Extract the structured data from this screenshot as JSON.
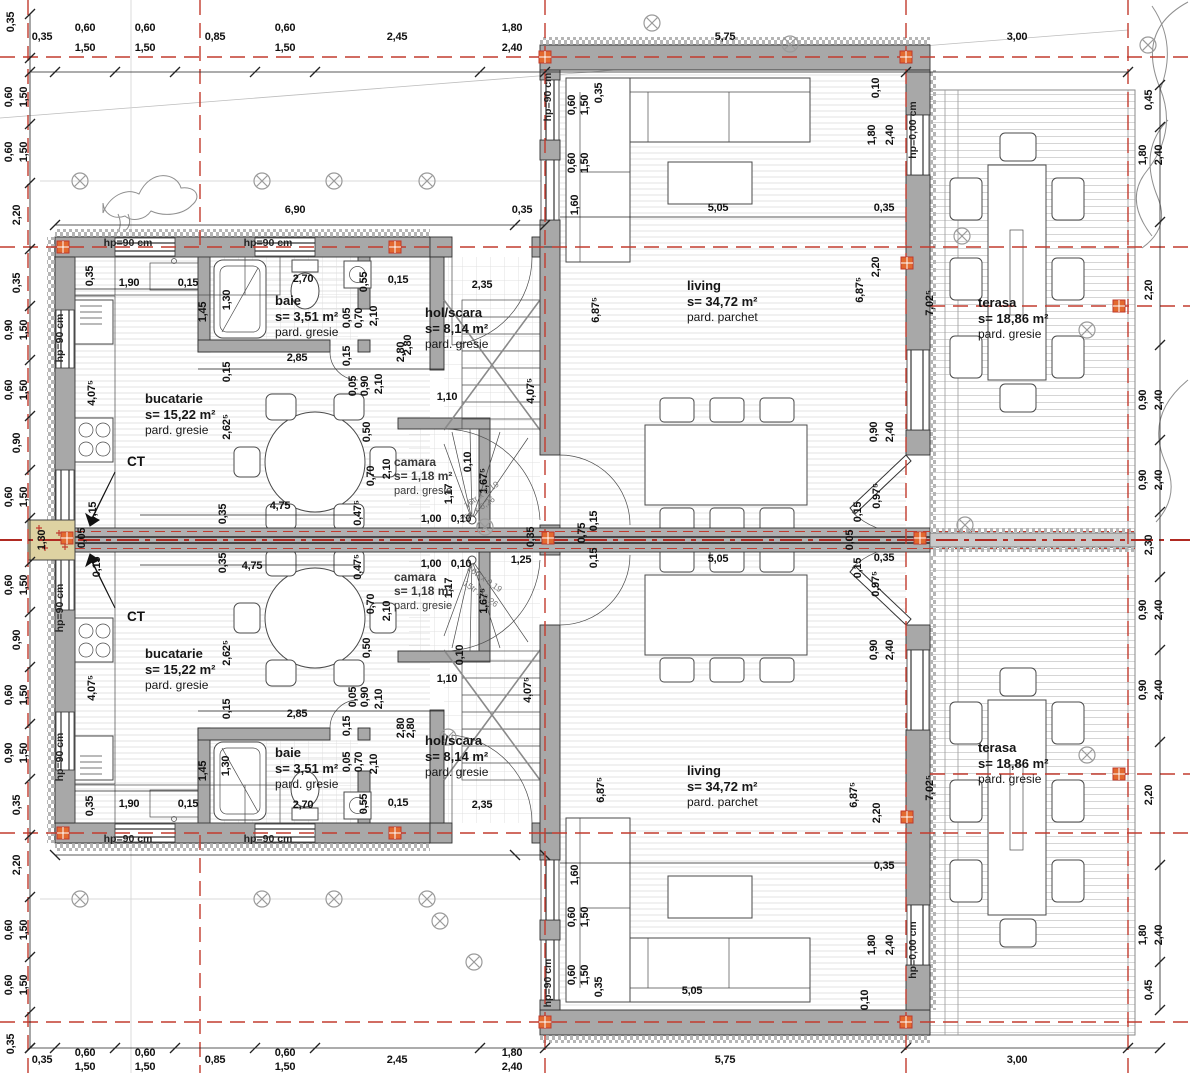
{
  "rooms": {
    "bucatarie": {
      "name": "bucatarie",
      "area": "s= 15,22 m²",
      "floor": "pard. gresie"
    },
    "baie": {
      "name": "baie",
      "area": "s= 3,51 m²",
      "floor": "pard. gresie"
    },
    "hol": {
      "name": "hol/scara",
      "area": "s= 8,14 m²",
      "floor": "pard. gresie"
    },
    "camara": {
      "name": "camara",
      "area": "s= 1,18 m²",
      "floor": "pard. gresie"
    },
    "living": {
      "name": "living",
      "area": "s= 34,72 m²",
      "floor": "pard. parchet"
    },
    "terasa": {
      "name": "terasa",
      "area": "s= 18,86 m²",
      "floor": "pard. gresie"
    }
  },
  "annotations": {
    "ct": "CT",
    "hp90": "hp=90 cm",
    "hp0": "hp=0,00 cm",
    "stair_note_a": "16tr x 0,19",
    "stair_note_b": "15tr x 0,26"
  },
  "dims": {
    "values": {
      "d005": "0,05",
      "d010": "0,10",
      "d015": "0,15",
      "d035": "0,35",
      "d045": "0,45",
      "d0475": "0,47⁵",
      "d050": "0,50",
      "d055": "0,55",
      "d060": "0,60",
      "d070": "0,70",
      "d075": "0,75",
      "d085": "0,85",
      "d090": "0,90",
      "d0975": "0,97⁵",
      "d100": "1,00",
      "d110": "1,10",
      "d117": "1,17",
      "d125": "1,25",
      "d130": "1,30",
      "d145": "1,45",
      "d150": "1,50",
      "d160": "1,60",
      "d1675": "1,67⁵",
      "d180": "1,80",
      "d190": "1,90",
      "d210": "2,10",
      "d220": "2,20",
      "d230": "2,30",
      "d235": "2,35",
      "d240": "2,40",
      "d245": "2,45",
      "d2625": "2,62⁵",
      "d270": "2,70",
      "d280": "2,80",
      "d285": "2,85",
      "d300": "3,00",
      "d4075": "4,07⁵",
      "d475": "4,75",
      "d505": "5,05",
      "d575": "5,75",
      "d6875": "6,87⁵",
      "d690": "6,90",
      "d7025": "7,02⁵"
    }
  },
  "colors": {
    "axis_red": "#c23b2e",
    "wall_gray": "#a8a8a8",
    "band_gray": "#b0b0b0",
    "party_wall_beige": "#ded2a2",
    "marker_orange": "#e2692f",
    "insulation_gray": "#b5b5b5"
  }
}
